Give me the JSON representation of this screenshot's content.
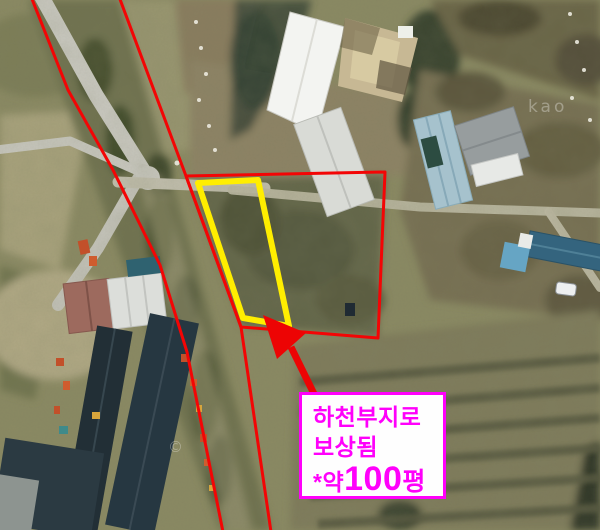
{
  "theme": {
    "boundary-red": "#f30505",
    "arrow-red": "#ed0404",
    "highlight-yellow": "#ffee00",
    "label-magenta": "#ff00fb",
    "label-bg": "#fefefe"
  },
  "annotation": {
    "line1": "하천부지로",
    "line2": "보상됨",
    "line3_prefix": "*약",
    "line3_number": "100",
    "line3_suffix": "평"
  },
  "watermarks": {
    "copyright": "©",
    "provider": "kao"
  }
}
